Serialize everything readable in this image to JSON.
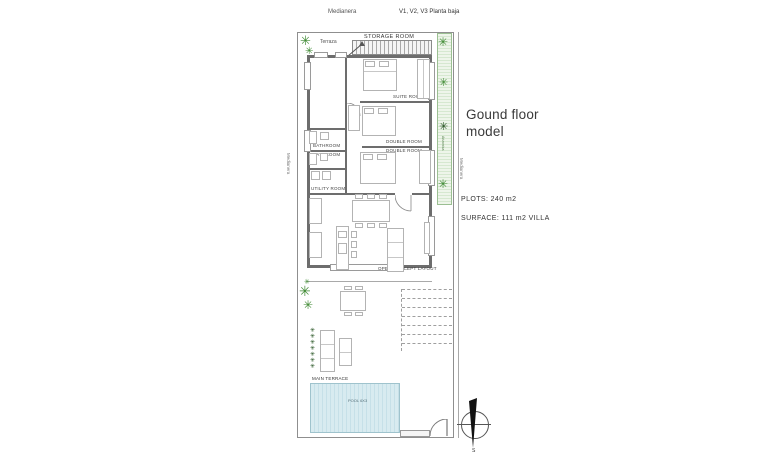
{
  "header": {
    "medianera_top": "Medianera",
    "plan_version": "V1, V2, V3 Planta baja"
  },
  "info": {
    "title": "Gound floor\nmodel",
    "plots": "PLOTS: 240 m2",
    "surface": "SURFACE: 111 m2 VILLA"
  },
  "boundaries": {
    "left_label": "Medianera",
    "right_label": "Medianera",
    "hedge_label": "Arizonica"
  },
  "rooms": {
    "terrace_top": "Terraza",
    "storage": "STORAGE ROOM",
    "suite": "SUITE ROOM",
    "bathroom_1": "BATHROOM",
    "bathroom_2": "BATHROOM",
    "double_1": "DOUBLE ROOM",
    "double_2": "DOUBLE ROOM",
    "utility": "UTILITY ROOM",
    "open_concept": "OPEN CONCEPT LAYOUT",
    "main_terrace": "MAIN TERRACE",
    "pool": "POOL 6X3"
  },
  "compass": {
    "south_label": "S"
  },
  "icons": {
    "plant": "✳"
  },
  "colors": {
    "wall": "#6d6d6d",
    "furniture_line": "#b3b3b3",
    "pool_fill": "#d8ebf0",
    "pool_border": "#9fc3cd",
    "hedge_fill": "#e4f0df",
    "plant_green": "#3f8a33",
    "boundary_line": "#8f8f8f",
    "text": "#444444"
  }
}
